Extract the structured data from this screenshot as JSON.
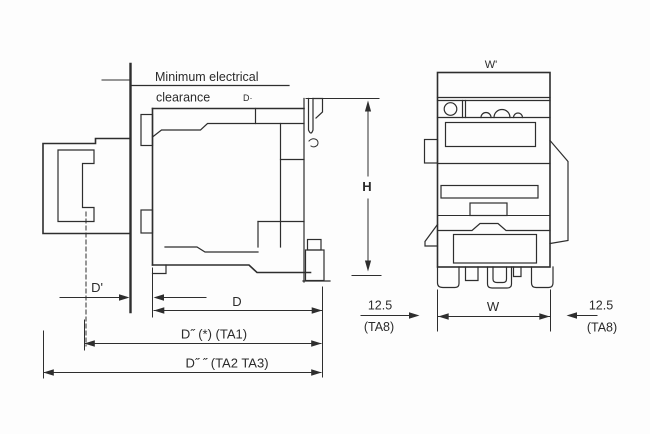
{
  "drawing": {
    "type": "contactor-dimension-drawing",
    "title_note": {
      "line1": "Minimum electrical",
      "line2": "clearance",
      "suffix": "D·"
    },
    "side_view": {
      "dims": {
        "d_prime": "D'",
        "d": "D",
        "d_ta1": "D˝ (*) (TA1)",
        "d_ta23": "D˝ ˝ (TA2 TA3)",
        "h": "H"
      }
    },
    "front_view": {
      "dims": {
        "w_prime": "W'",
        "w": "W",
        "left_offset": "12.5",
        "left_ref": "(TA8)",
        "right_offset": "12.5",
        "right_ref": "(TA8)"
      }
    },
    "colors": {
      "line": "#2e2e2e",
      "background": "#fdfdfd",
      "text": "#2b2b2b"
    }
  }
}
